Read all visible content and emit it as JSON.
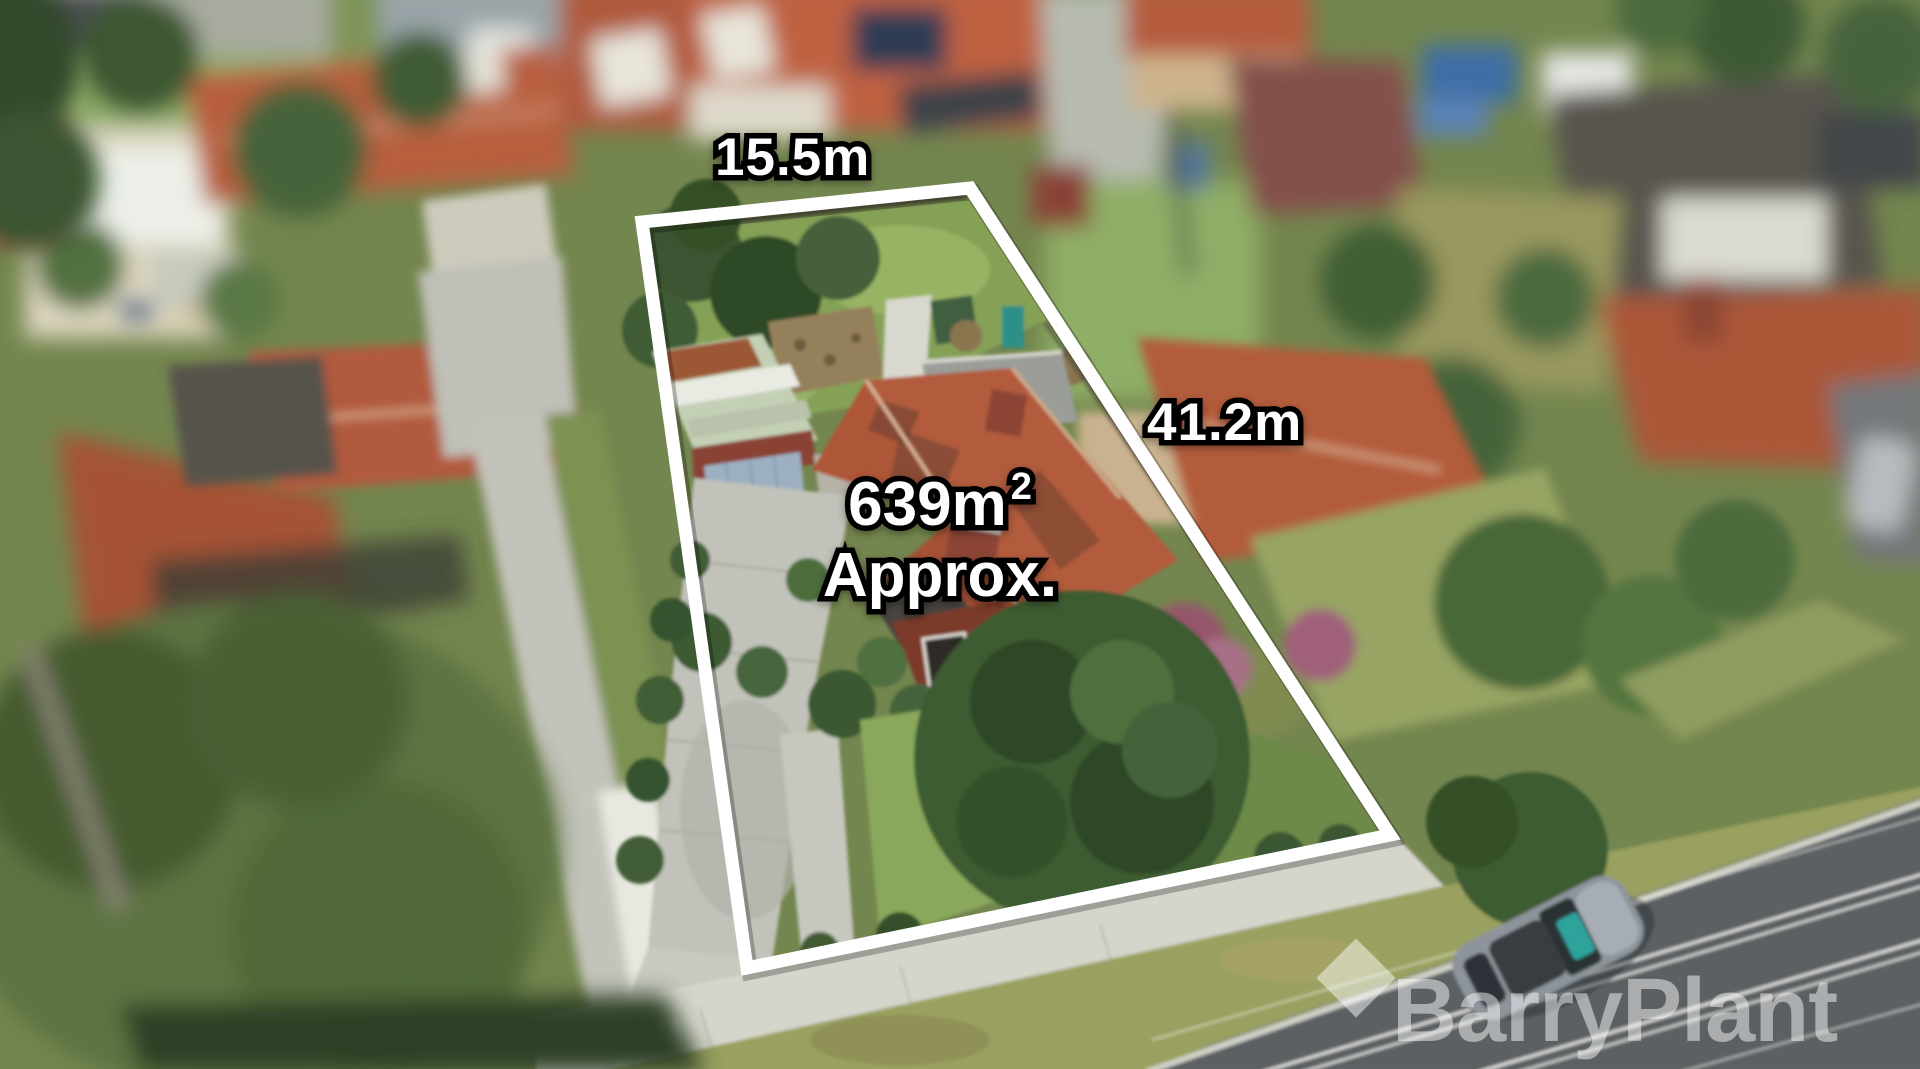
{
  "overlay": {
    "frontage_label": "15.5m",
    "depth_label": "41.2m",
    "area_value": "639m",
    "area_exponent": "2",
    "area_qualifier": "Approx."
  },
  "watermark": {
    "brand": "BarryPlant"
  },
  "colors": {
    "boundary": "#ffffff",
    "label_fill": "#ffffff",
    "label_outline": "#000000",
    "watermark_white": "rgba(255,255,255,0.48)",
    "roof_terracotta": "#b25c3c",
    "lawn_green": "#85a157",
    "road_asphalt": "#5b6064",
    "driveway_concrete": "#c1c2b9"
  }
}
